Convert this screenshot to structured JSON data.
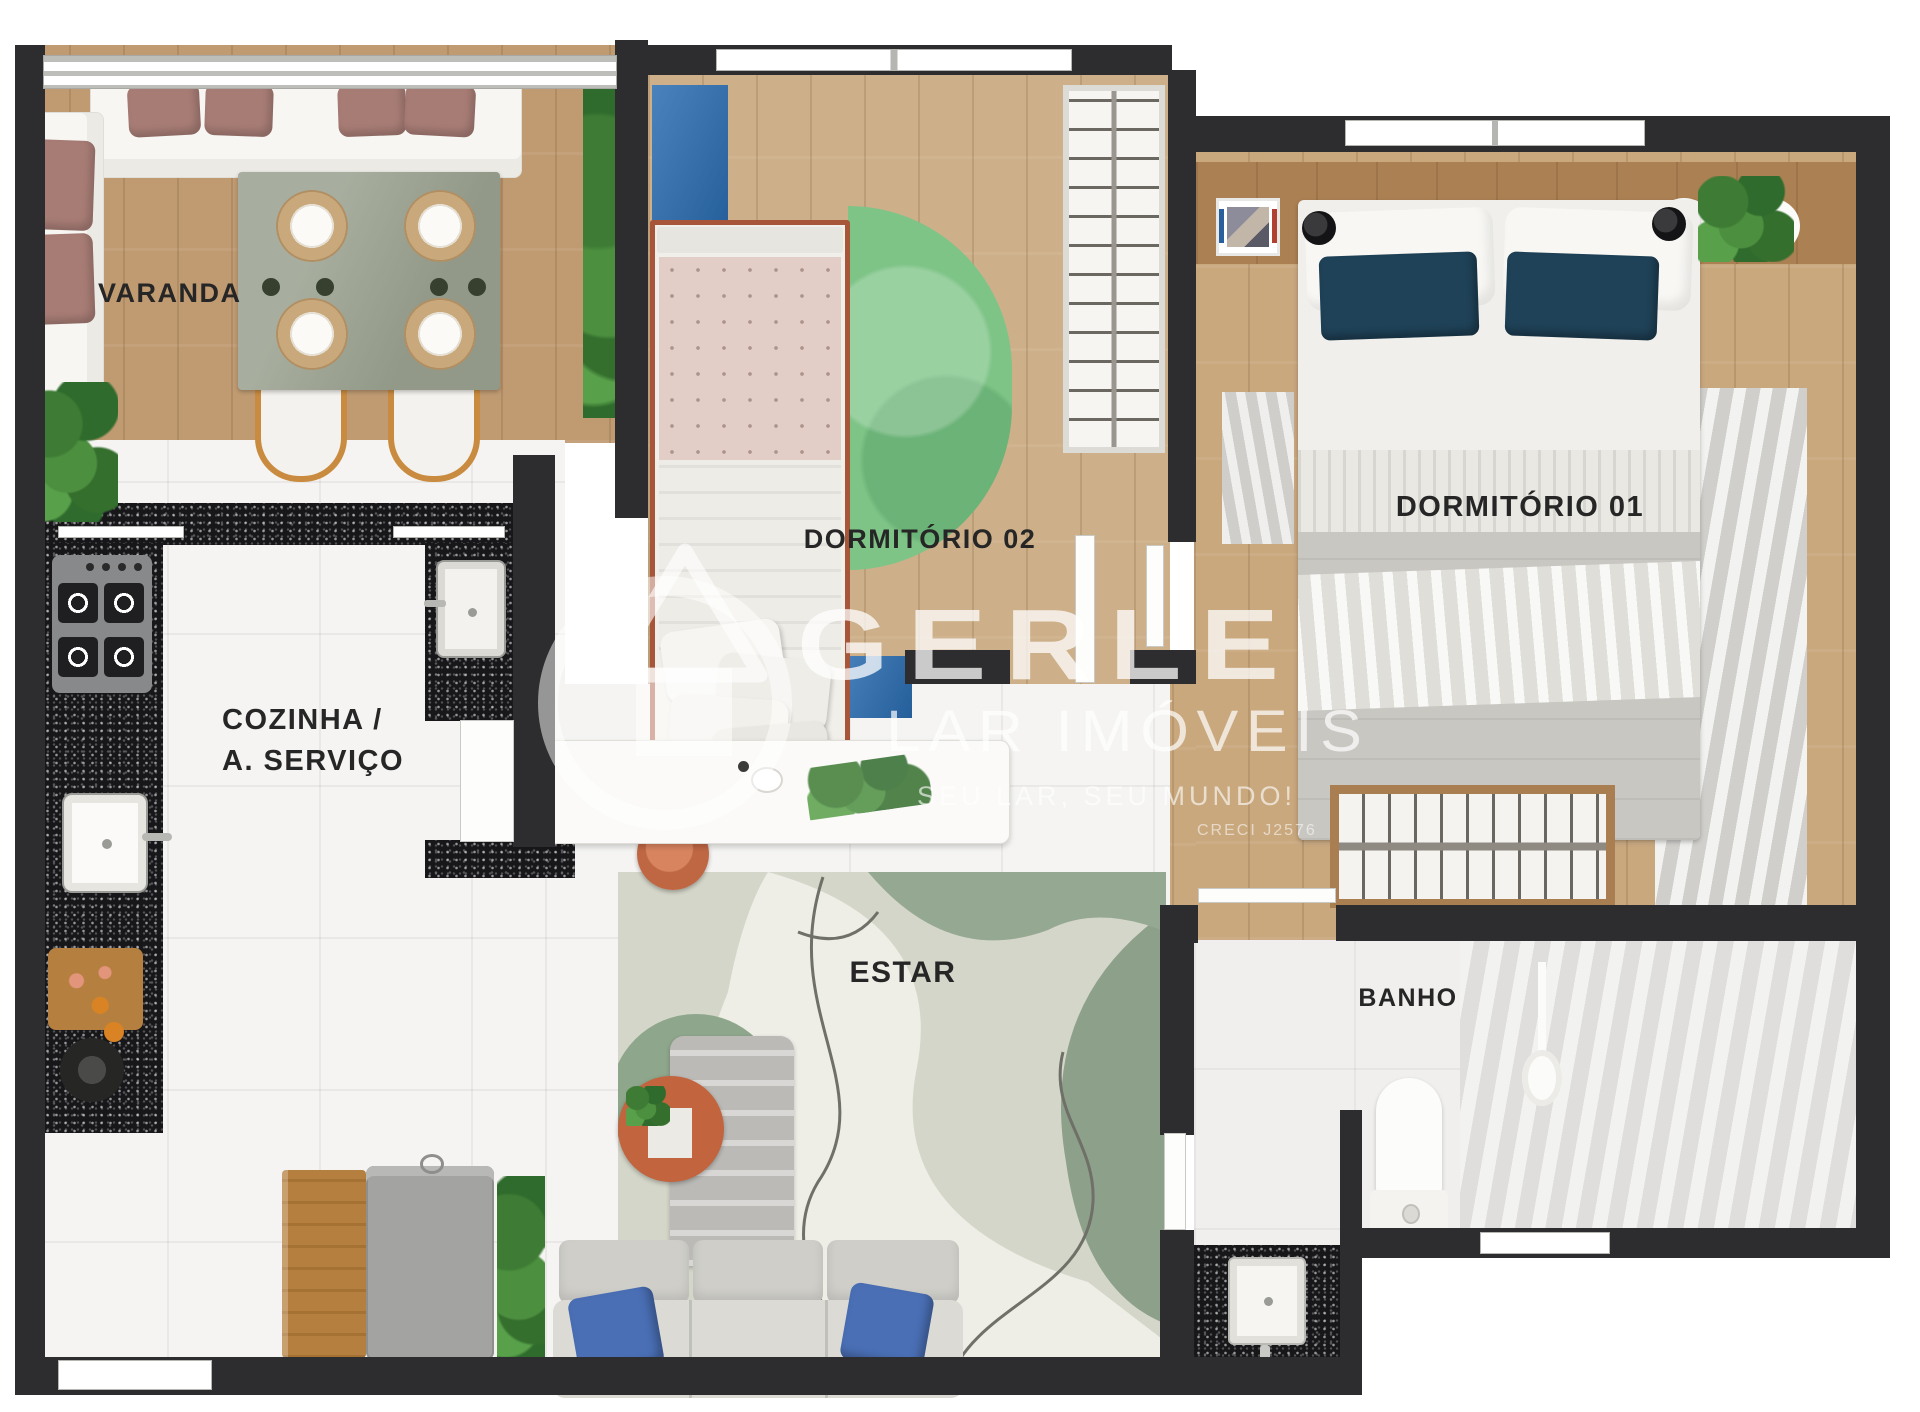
{
  "rooms": {
    "varanda": {
      "label": "VARANDA"
    },
    "cozinha": {
      "line1": "COZINHA /",
      "line2": "A. SERVIÇO"
    },
    "dormitorio02": {
      "label": "DORMITÓRIO 02"
    },
    "dormitorio01": {
      "label": "DORMITÓRIO 01"
    },
    "estar": {
      "label": "ESTAR"
    },
    "banho": {
      "label": "BANHO"
    }
  },
  "watermark": {
    "brand": "GERLE",
    "subtitle": "LAR IMÓVEIS",
    "tagline": "SEU LAR, SEU MUNDO!",
    "license": "CRECI J2576"
  },
  "colors": {
    "wall": "#2d2d2f",
    "wood_floor": "#c9a87e",
    "tile_floor": "#f5f4f2",
    "granite_counter": "#17171a",
    "green_rug": "#7ec487",
    "blue_furniture": "#2a6cb0",
    "navy_pillow": "#1f4258",
    "mauve_pillow": "#a77c75",
    "terracotta": "#bf6743",
    "sage_rug": "#8ea68c",
    "label_text": "#262626"
  }
}
